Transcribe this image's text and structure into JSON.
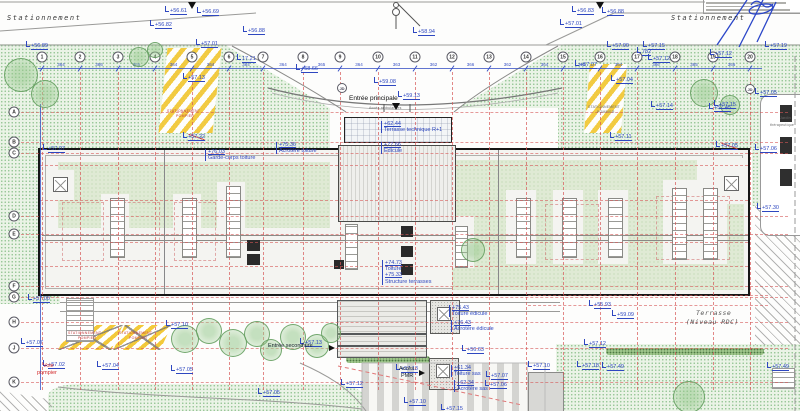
{
  "plan": {
    "colors": {
      "annotation_blue": "#2e47c0",
      "grid_red": "#d65656",
      "hatch_yellow": "#f3c93a",
      "vegetation_green": "#93c493",
      "roof_green": "#dfead4",
      "fire_red": "#d22a2a",
      "building_black": "#161616"
    },
    "grid": {
      "columns": [
        {
          "label": "1",
          "x": 42
        },
        {
          "label": "2",
          "x": 80
        },
        {
          "label": "3",
          "x": 118
        },
        {
          "label": "4",
          "x": 155
        },
        {
          "label": "5",
          "x": 192
        },
        {
          "label": "6",
          "x": 229
        },
        {
          "label": "7",
          "x": 263
        },
        {
          "label": "8",
          "x": 303
        },
        {
          "label": "9",
          "x": 340
        },
        {
          "label": "10",
          "x": 378
        },
        {
          "label": "11",
          "x": 415
        },
        {
          "label": "12",
          "x": 452
        },
        {
          "label": "13",
          "x": 489
        },
        {
          "label": "14",
          "x": 526
        },
        {
          "label": "15",
          "x": 563
        },
        {
          "label": "16",
          "x": 600
        },
        {
          "label": "17",
          "x": 637
        },
        {
          "label": "18",
          "x": 675
        },
        {
          "label": "19",
          "x": 713
        },
        {
          "label": "20",
          "x": 750
        }
      ],
      "rows": [
        {
          "label": "A",
          "y": 112
        },
        {
          "label": "B",
          "y": 142
        },
        {
          "label": "C",
          "y": 153
        },
        {
          "label": "D",
          "y": 216
        },
        {
          "label": "E",
          "y": 234
        },
        {
          "label": "F",
          "y": 286
        },
        {
          "label": "G",
          "y": 297
        },
        {
          "label": "H",
          "y": 322
        },
        {
          "label": "J",
          "y": 348
        },
        {
          "label": "K",
          "y": 382
        }
      ],
      "column_dims": [
        "364",
        "366",
        "365",
        "364",
        "364",
        "364",
        "364",
        "365",
        "364",
        "363",
        "362",
        "366",
        "362",
        "364",
        "365",
        "364",
        "366",
        "365",
        "366"
      ],
      "extra_rows": [
        {
          "y": 165,
          "x": 40,
          "w": 708
        },
        {
          "y": 200,
          "x": 40,
          "w": 708
        },
        {
          "y": 242,
          "x": 40,
          "w": 708
        },
        {
          "y": 266,
          "x": 40,
          "w": 708
        },
        {
          "y": 295,
          "x": 528,
          "w": 240
        },
        {
          "y": 305,
          "x": 528,
          "w": 240
        }
      ],
      "jd_bubbles": [
        {
          "label": "JD",
          "x": 342,
          "y": 88
        },
        {
          "label": "JD",
          "x": 750,
          "y": 89
        }
      ]
    },
    "spot_elevations": [
      {
        "t": "+56.61",
        "x": 165,
        "y": 6
      },
      {
        "t": "+56.69",
        "x": 197,
        "y": 7
      },
      {
        "t": "+56.82",
        "x": 150,
        "y": 20
      },
      {
        "t": "+56.88",
        "x": 243,
        "y": 26
      },
      {
        "t": "+56.89",
        "x": 26,
        "y": 41
      },
      {
        "t": "+57.01",
        "x": 196,
        "y": 39
      },
      {
        "t": "+56.83",
        "x": 572,
        "y": 6
      },
      {
        "t": "+56.88",
        "x": 602,
        "y": 7
      },
      {
        "t": "+57.01",
        "x": 560,
        "y": 19
      },
      {
        "t": "+57.00",
        "x": 607,
        "y": 41
      },
      {
        "t": "+57.15",
        "x": 643,
        "y": 41
      },
      {
        "t": "+57.19",
        "x": 765,
        "y": 41
      },
      {
        "t": "+57.12",
        "x": 648,
        "y": 54
      },
      {
        "t": "+57.12",
        "x": 710,
        "y": 49
      },
      {
        "t": "+58.94",
        "x": 413,
        "y": 27
      },
      {
        "t": "+58.66",
        "x": 296,
        "y": 64
      },
      {
        "t": "+57.07",
        "x": 575,
        "y": 60
      },
      {
        "t": "+57.04",
        "x": 611,
        "y": 75
      },
      {
        "t": "+57.13",
        "x": 183,
        "y": 73
      },
      {
        "t": "+59.08",
        "x": 374,
        "y": 77
      },
      {
        "t": "+59.13",
        "x": 398,
        "y": 91
      },
      {
        "t": "17.21",
        "x": 237,
        "y": 54
      },
      {
        "t": "782",
        "x": 637,
        "y": 47
      },
      {
        "t": "+57.14",
        "x": 651,
        "y": 101
      },
      {
        "t": "+57.15",
        "x": 714,
        "y": 100
      },
      {
        "t": "+57.05",
        "x": 755,
        "y": 88
      },
      {
        "t": "+57.11",
        "x": 610,
        "y": 132
      },
      {
        "t": "+57.22",
        "x": 183,
        "y": 132,
        "cls": "struck"
      },
      {
        "t": "+57.07",
        "x": 43,
        "y": 144
      },
      {
        "t": "+57.45",
        "x": 709,
        "y": 103
      },
      {
        "t": "+57.05",
        "x": 716,
        "y": 141,
        "cls": "struck"
      },
      {
        "t": "+57.06",
        "x": 755,
        "y": 144
      },
      {
        "t": "+57.30",
        "x": 757,
        "y": 203
      },
      {
        "t": "+57.00",
        "x": 28,
        "y": 294
      },
      {
        "t": "+57.10",
        "x": 166,
        "y": 320
      },
      {
        "t": "+57.07",
        "x": 21,
        "y": 338
      },
      {
        "t": "+57.02",
        "x": 43,
        "y": 360
      },
      {
        "t": "+57.04",
        "x": 97,
        "y": 361
      },
      {
        "t": "+57.05",
        "x": 171,
        "y": 365
      },
      {
        "t": "+57.13",
        "x": 300,
        "y": 338
      },
      {
        "t": "+57.12",
        "x": 341,
        "y": 379
      },
      {
        "t": "+57.13",
        "x": 396,
        "y": 364
      },
      {
        "t": "+57.07",
        "x": 486,
        "y": 371
      },
      {
        "t": "+57.06",
        "x": 485,
        "y": 380
      },
      {
        "t": "+57.10",
        "x": 404,
        "y": 397
      },
      {
        "t": "+57.15",
        "x": 441,
        "y": 404
      },
      {
        "t": "+56.63",
        "x": 462,
        "y": 345
      },
      {
        "t": "+55.93",
        "x": 589,
        "y": 300
      },
      {
        "t": "+59.09",
        "x": 612,
        "y": 310
      },
      {
        "t": "+57.12",
        "x": 584,
        "y": 339
      },
      {
        "t": "+57.10",
        "x": 528,
        "y": 361
      },
      {
        "t": "+57.18",
        "x": 577,
        "y": 361
      },
      {
        "t": "+57.49",
        "x": 602,
        "y": 362
      },
      {
        "t": "+57.49",
        "x": 767,
        "y": 362
      },
      {
        "t": "+57.05",
        "x": 258,
        "y": 388
      }
    ],
    "callouts": [
      {
        "lines": [
          "+76.03",
          "Garde-corps toiture"
        ],
        "x": 205,
        "y": 149
      },
      {
        "lines": [
          "+75.36",
          "Acrotère toiture"
        ],
        "x": 276,
        "y": 142
      },
      {
        "lines": [
          "+77.66",
          "Édicule"
        ],
        "x": 381,
        "y": 142
      },
      {
        "lines": [
          "+62.44",
          "Terrasse technique R+1"
        ],
        "x": 381,
        "y": 121
      },
      {
        "lines": [
          "+74.73",
          "Toiture",
          "+75.33",
          "Structure terrasses"
        ],
        "x": 382,
        "y": 260
      },
      {
        "lines": [
          "+75.43",
          "Toiture édicule"
        ],
        "x": 449,
        "y": 305
      },
      {
        "lines": [
          "+76.43",
          "Acrotère édicule"
        ],
        "x": 451,
        "y": 320
      },
      {
        "lines": [
          "+61.34",
          "Toiture sas"
        ],
        "x": 451,
        "y": 365
      },
      {
        "lines": [
          "+62.34",
          "Acrotère sas"
        ],
        "x": 454,
        "y": 380
      }
    ],
    "labels": [
      {
        "t": "Stationnement",
        "x": 7,
        "y": 14,
        "cls": "area"
      },
      {
        "t": "Stationnement",
        "x": 671,
        "y": 14,
        "cls": "area"
      },
      {
        "t": "Entrée principale",
        "x": 349,
        "y": 95,
        "cls": "entry"
      },
      {
        "t": "Accès ambulances",
        "x": 369,
        "y": 106,
        "cls": "tiny-gray"
      },
      {
        "t": "Entrée secondaire",
        "x": 268,
        "y": 343,
        "cls": "entry-sm"
      },
      {
        "t": "Accès",
        "x": 399,
        "y": 366,
        "cls": "entry-sm"
      },
      {
        "t": "PMR",
        "x": 401,
        "y": 373,
        "cls": "entry-sm"
      },
      {
        "t": "Terrasse",
        "x": 696,
        "y": 309,
        "cls": "area-it"
      },
      {
        "t": "(Niveau RDC)",
        "x": 686,
        "y": 318,
        "cls": "area-it"
      },
      {
        "t": "Voie",
        "x": 43,
        "y": 363,
        "cls": "fire"
      },
      {
        "t": "pompier",
        "x": 37,
        "y": 370,
        "cls": "fire"
      },
      {
        "t": "Jardin",
        "x": 780,
        "y": 116,
        "cls": "tiny-gray"
      },
      {
        "t": "thérapeutique",
        "x": 770,
        "y": 123,
        "cls": "tiny-gray"
      },
      {
        "t": "STATIONNEMENT",
        "x": 167,
        "y": 109,
        "cls": "tiny-red"
      },
      {
        "t": "POMPIER",
        "x": 176,
        "y": 114,
        "cls": "tiny-red"
      },
      {
        "t": "STATIONNEMENT",
        "x": 588,
        "y": 105,
        "cls": "tiny-gray"
      },
      {
        "t": "POMPIER",
        "x": 597,
        "y": 110,
        "cls": "tiny-gray"
      },
      {
        "t": "STATIONNEMENT",
        "x": 68,
        "y": 331,
        "cls": "tiny-red"
      },
      {
        "t": "POMPIER",
        "x": 78,
        "y": 336,
        "cls": "tiny-red"
      },
      {
        "t": "STATIONNEMENT",
        "x": 119,
        "y": 331,
        "cls": "tiny-red"
      },
      {
        "t": "POMPIER",
        "x": 129,
        "y": 336,
        "cls": "tiny-red"
      }
    ],
    "markers": [
      {
        "cls": "tri-down",
        "x": 188,
        "y": 2
      },
      {
        "cls": "tri-down",
        "x": 596,
        "y": 2
      },
      {
        "cls": "tri-down",
        "x": 392,
        "y": 103
      },
      {
        "cls": "tri-right",
        "x": 329,
        "y": 345
      },
      {
        "cls": "tri-right",
        "x": 419,
        "y": 370
      }
    ],
    "trees": [
      {
        "x": 20,
        "y": 74,
        "r": 16
      },
      {
        "x": 44,
        "y": 93,
        "r": 13
      },
      {
        "x": 138,
        "y": 56,
        "r": 9
      },
      {
        "x": 154,
        "y": 49,
        "r": 7
      },
      {
        "x": 703,
        "y": 92,
        "r": 13
      },
      {
        "x": 729,
        "y": 104,
        "r": 9
      },
      {
        "x": 472,
        "y": 249,
        "r": 11
      },
      {
        "x": 184,
        "y": 338,
        "r": 13
      },
      {
        "x": 208,
        "y": 330,
        "r": 12
      },
      {
        "x": 232,
        "y": 342,
        "r": 13
      },
      {
        "x": 256,
        "y": 333,
        "r": 12
      },
      {
        "x": 270,
        "y": 349,
        "r": 10
      },
      {
        "x": 292,
        "y": 336,
        "r": 12
      },
      {
        "x": 316,
        "y": 345,
        "r": 11
      },
      {
        "x": 330,
        "y": 332,
        "r": 9
      },
      {
        "x": 688,
        "y": 396,
        "r": 15
      }
    ]
  }
}
